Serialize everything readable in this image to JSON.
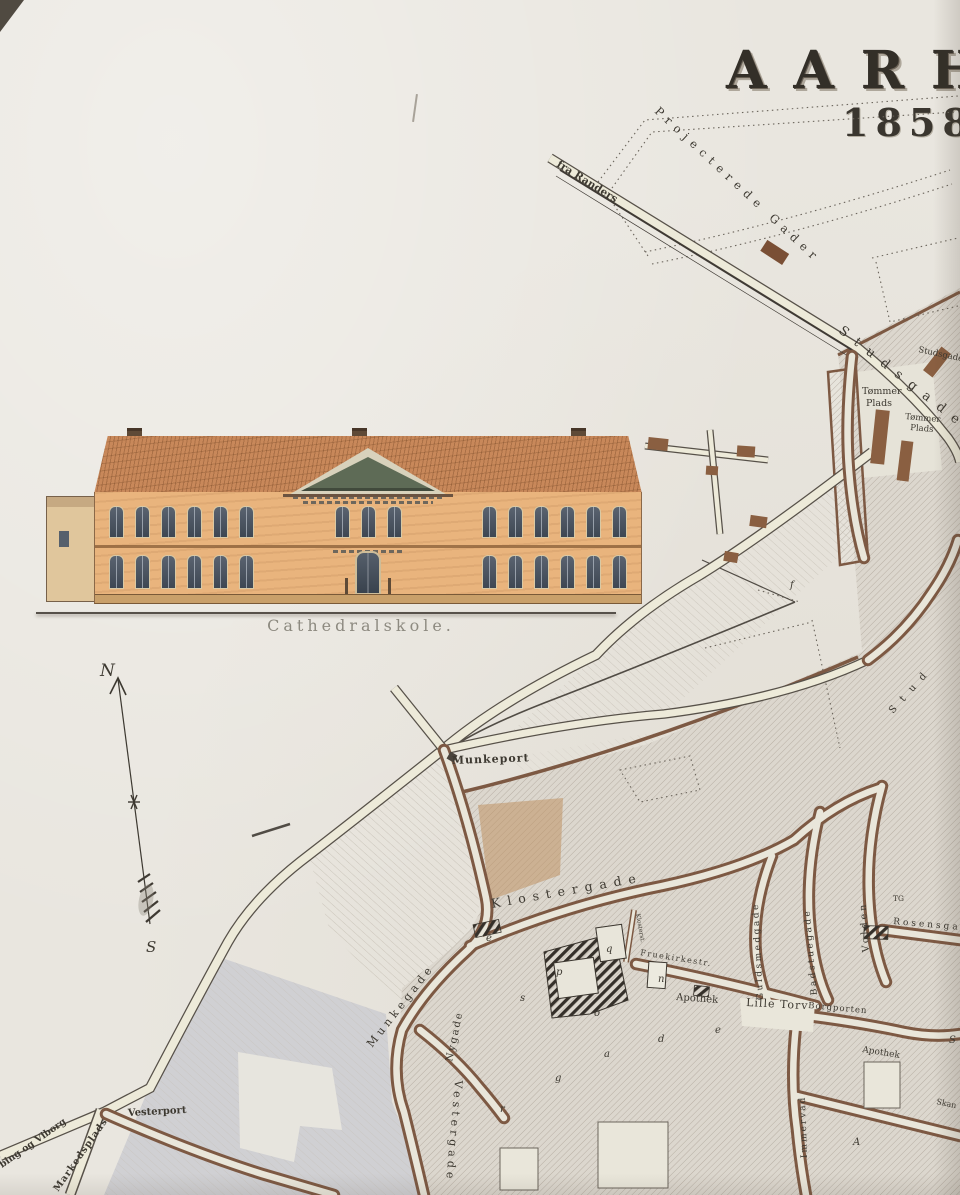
{
  "title": {
    "name": "AARH",
    "year": "1858."
  },
  "elevation": {
    "caption": "Cathedralskole."
  },
  "compass": {
    "north": "N",
    "south": "S"
  },
  "map": {
    "labels": {
      "fra_randers": "fra Randers",
      "projected_gader": "Projecterede Gader",
      "studsgade_road": "Studsgade",
      "studsgade_small": "Studsgade",
      "stud_partial": "Stud",
      "tommerplads1_l1": "Tømmer",
      "tommerplads1_l2": "Plads",
      "tommerplads2_l1": "Tømmer",
      "tommerplads2_l2": "Plads",
      "munkeport": "Munkeport",
      "klostergade": "Klostergade",
      "munkegade": "Munkegade",
      "nygade": "Nygade",
      "vestergade": "Vestergade",
      "klosterstraede": "Klosterst.",
      "fruekirkestraede": "Fruekirkestr.",
      "apothek1": "Apothek",
      "apothek2": "Apothek",
      "lille_torv": "Lille Torv",
      "borgporten": "Borgporten",
      "guldsmedgade": "Guldsmedgade",
      "badstuegade": "Badstuegade",
      "volden": "Volden",
      "rosensgade": "Rosensgade",
      "immervad": "Immervad",
      "skan_partial": "Skan",
      "vesterport": "Vesterport",
      "markedsplads": "Markedsplads",
      "viborg_road": "bing og Viborg",
      "tg_marker": "TG"
    },
    "reference_letters": [
      "f",
      "e",
      "s",
      "p",
      "q",
      "o",
      "n",
      "d",
      "e",
      "a",
      "g",
      "r",
      "A",
      "S"
    ]
  },
  "colors": {
    "paper": "#e9e6df",
    "ink": "#3d3931",
    "road-fill": "#edead9",
    "road-edge": "#575149",
    "block-border": "#7d5943",
    "block-fill": "#dcd7ce",
    "hatch": "#b7b0a6",
    "tan-wash": "#bf9263",
    "dark-hatch": "#35302a",
    "facade": "#e9b47d",
    "roof": "#c8885a",
    "window": "#4e5663",
    "gray-wash": "#d0d0d3",
    "caption": "#8d8a80"
  }
}
